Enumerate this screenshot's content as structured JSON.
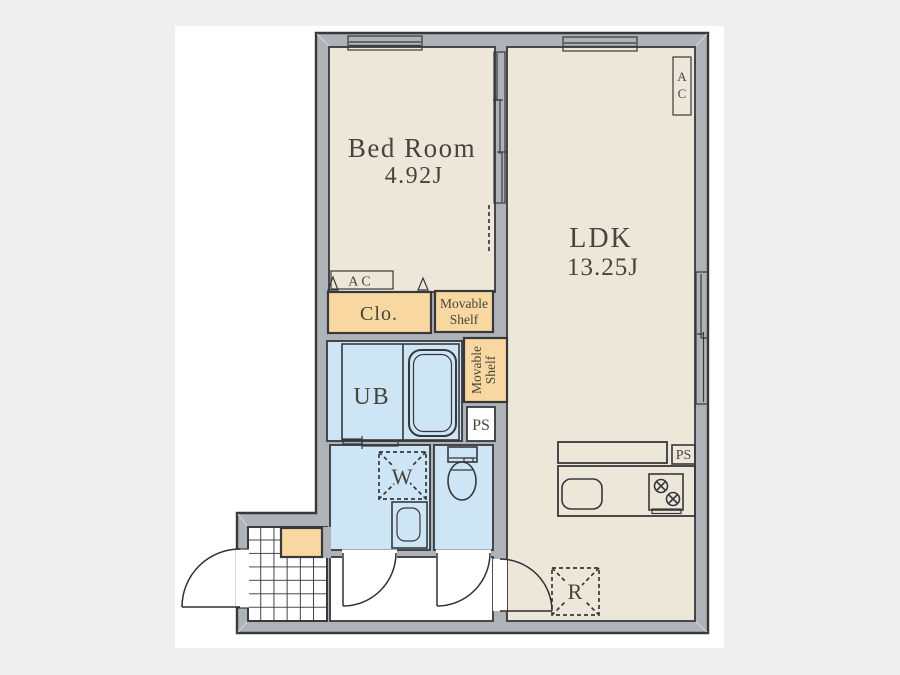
{
  "rooms": {
    "bedroom": {
      "name": "Bed Room",
      "size": "4.92J"
    },
    "ldk": {
      "name": "LDK",
      "size": "13.25J"
    },
    "closet": {
      "label": "Clo."
    },
    "unit_bath": {
      "label": "UB"
    }
  },
  "storage": {
    "shelf_upper": {
      "line1": "Movable",
      "line2": "Shelf"
    },
    "shelf_side": {
      "line1": "Movable",
      "line2": "Shelf"
    }
  },
  "equipment": {
    "ac_bedroom": "AC",
    "ac_ldk": {
      "line1": "A",
      "line2": "C"
    },
    "ps_bath": "PS",
    "ps_kitchen": "PS",
    "washer": "W",
    "refrigerator": "R"
  },
  "colors": {
    "background": "#efefef",
    "page": "#ffffff",
    "wall": "#aeb3b8",
    "floor": "#ede7d9",
    "wet_area": "#cde5f5",
    "storage": "#f9d7a0",
    "line": "#37383b"
  }
}
